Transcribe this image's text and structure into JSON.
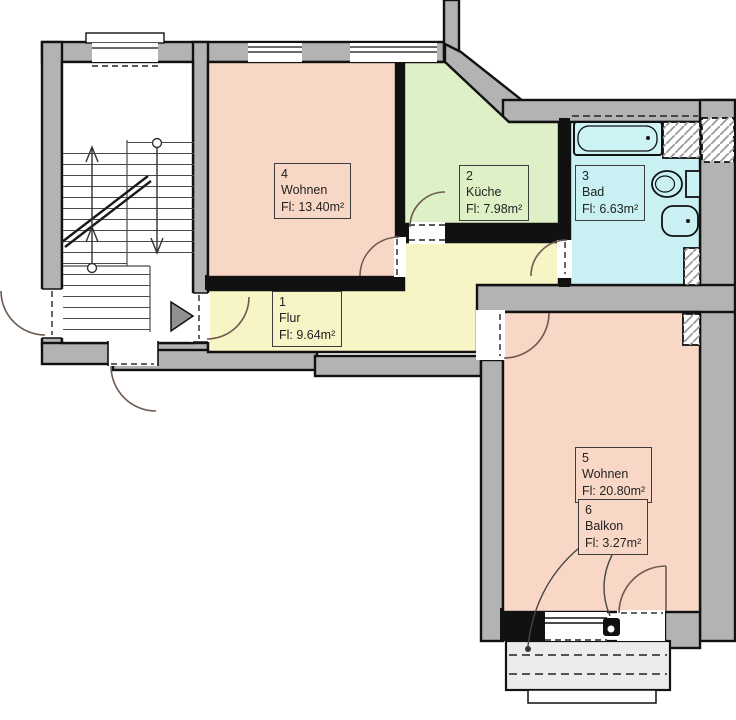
{
  "plan": {
    "type": "floor-plan",
    "rooms": [
      {
        "id": "flur",
        "number": "1",
        "name": "Flur",
        "area": "Fl: 9.64m²"
      },
      {
        "id": "kueche",
        "number": "2",
        "name": "Küche",
        "area": "Fl: 7.98m²"
      },
      {
        "id": "bad",
        "number": "3",
        "name": "Bad",
        "area": "Fl: 6.63m²"
      },
      {
        "id": "wohnen4",
        "number": "4",
        "name": "Wohnen",
        "area": "Fl: 13.40m²"
      },
      {
        "id": "wohnen5",
        "number": "5",
        "name": "Wohnen",
        "area": "Fl: 20.80m²"
      },
      {
        "id": "balkon",
        "number": "6",
        "name": "Balkon",
        "area": "Fl: 3.27m²"
      }
    ],
    "colors": {
      "wall": "#b3b3b3",
      "living": "#f9d7c7",
      "kitchen": "#def0c6",
      "bath": "#c9f1f3",
      "hall": "#f7f4c6",
      "stairwell": "#ffffff",
      "balcony_slab": "#ececec",
      "outline": "#111111"
    },
    "fixtures": [
      {
        "name": "staircase"
      },
      {
        "name": "bathtub"
      },
      {
        "name": "toilet"
      },
      {
        "name": "washbasin"
      },
      {
        "name": "balcony"
      },
      {
        "name": "entrance-arrow"
      }
    ]
  }
}
